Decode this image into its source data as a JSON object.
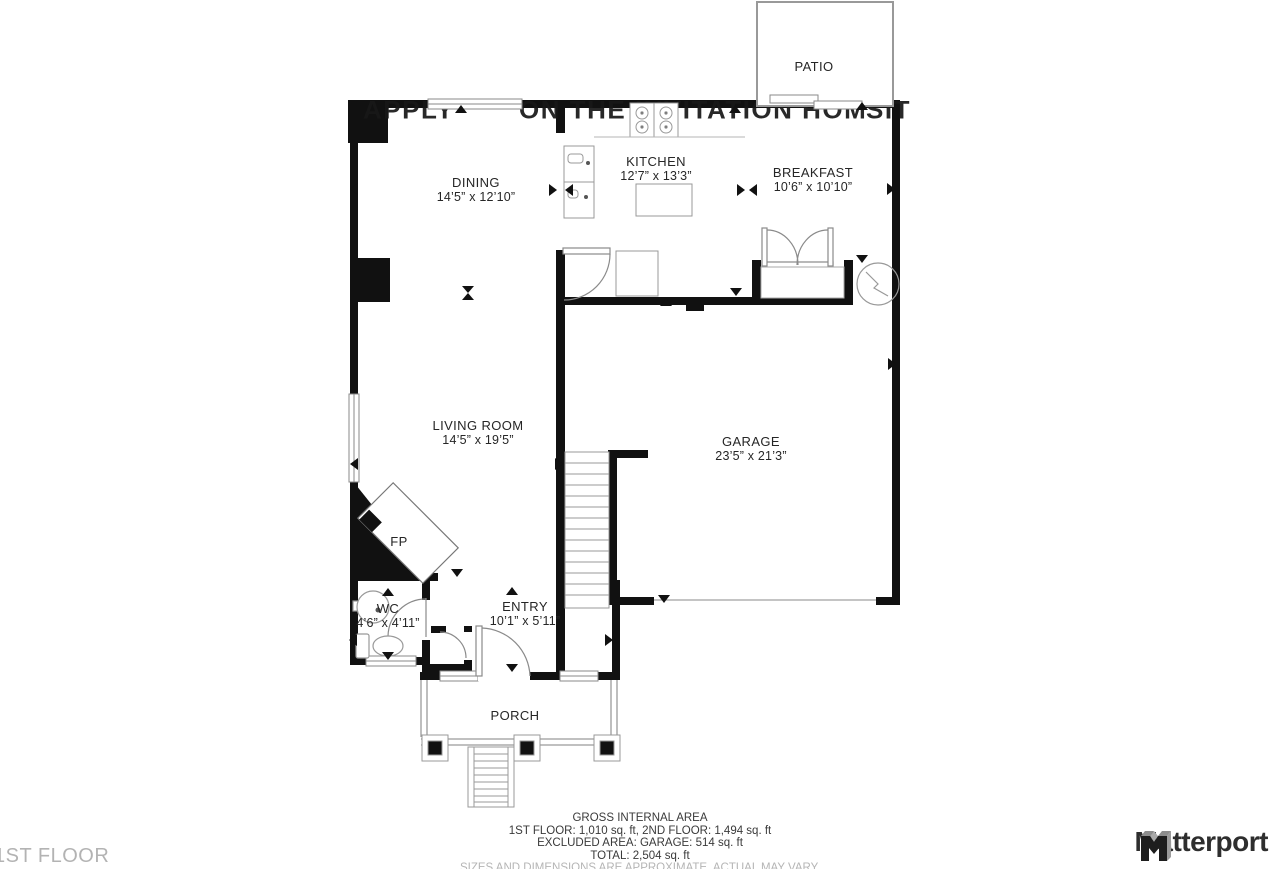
{
  "watermark": {
    "segments": [
      {
        "text": "APPLY",
        "x": 363
      },
      {
        "text": "ON THE INVITATION HOM",
        "x": 519
      },
      {
        "text": "SIT",
        "x": 866
      }
    ]
  },
  "rooms": [
    {
      "id": "patio",
      "name": "PATIO",
      "dims": ""
    },
    {
      "id": "dining",
      "name": "DINING",
      "dims": "14’5” x 12’10”"
    },
    {
      "id": "kitchen",
      "name": "KITCHEN",
      "dims": "12’7” x 13’3”"
    },
    {
      "id": "breakfast",
      "name": "BREAKFAST",
      "dims": "10’6” x 10’10”"
    },
    {
      "id": "living",
      "name": "LIVING ROOM",
      "dims": "14’5” x 19’5”"
    },
    {
      "id": "garage",
      "name": "GARAGE",
      "dims": "23’5” x 21’3”"
    },
    {
      "id": "wc",
      "name": "WC",
      "dims": "4’6” x 4’11”"
    },
    {
      "id": "entry",
      "name": "ENTRY",
      "dims": "10’1” x 5’11”"
    },
    {
      "id": "porch",
      "name": "PORCH",
      "dims": ""
    },
    {
      "id": "fireplace",
      "name": "FP",
      "dims": ""
    }
  ],
  "footer": {
    "area_title": "GROSS INTERNAL AREA",
    "line1": "1ST FLOOR: 1,010 sq. ft, 2ND FLOOR: 1,494 sq. ft",
    "line2": "EXCLUDED AREA: GARAGE: 514 sq. ft",
    "line3": "TOTAL: 2,504 sq. ft",
    "disclaimer": "SIZES AND DIMENSIONS ARE APPROXIMATE, ACTUAL MAY VARY.",
    "floor_label": "1ST FLOOR",
    "brand": "Matterport"
  },
  "colors": {
    "wall": "#111111",
    "fixture": "#999999",
    "label": "#262626",
    "muted": "#b3b3b3"
  }
}
